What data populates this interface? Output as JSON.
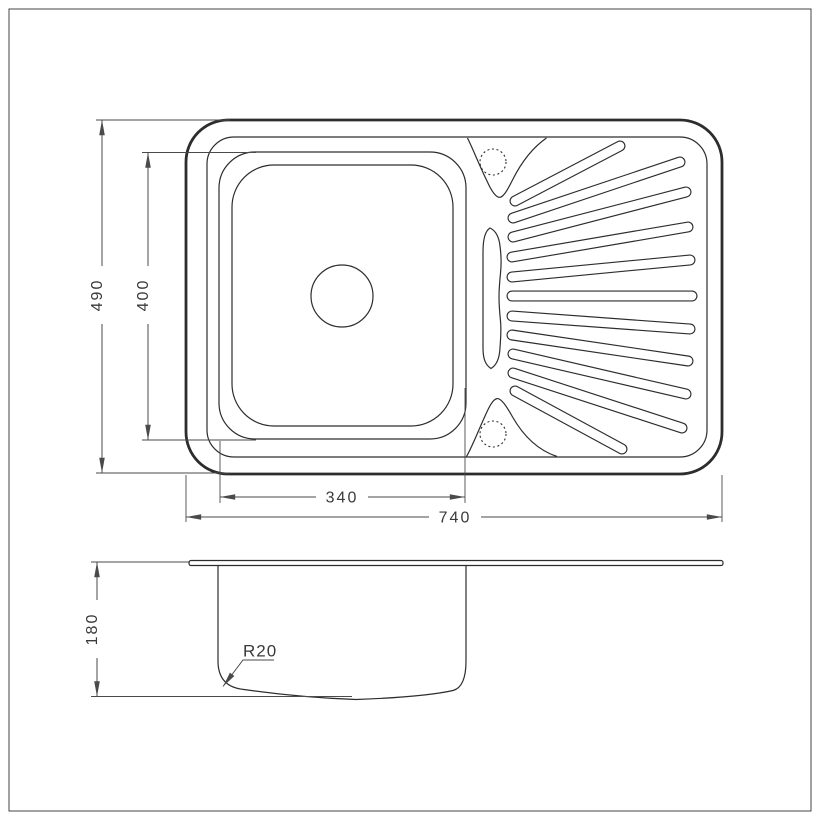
{
  "drawing_title": "kitchen-sink-technical-drawing",
  "top_view": {
    "width_label": "740",
    "height_label": "490",
    "basin_width_label": "340",
    "basin_height_label": "400"
  },
  "side_view": {
    "depth_label": "180",
    "corner_radius_label": "R20"
  },
  "palette": {
    "line": "#2d2d2d",
    "dim": "#4a4a4a",
    "text": "#3a3a3a",
    "border": "#444444",
    "bg": "#ffffff"
  }
}
